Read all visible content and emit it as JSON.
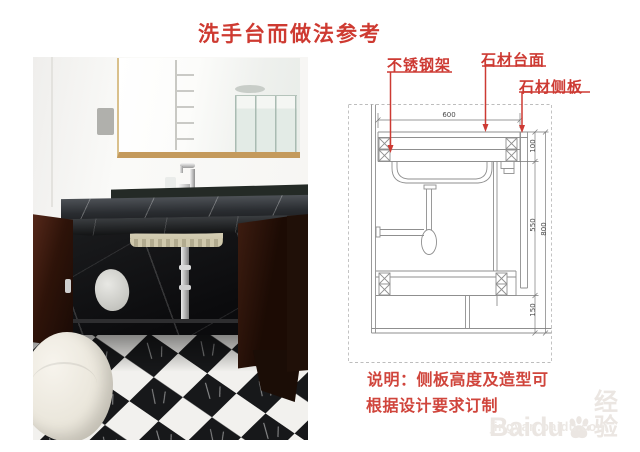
{
  "title": "洗手台而做法参考",
  "colors": {
    "accent_red": "#ce3a31",
    "drawing_line": "#909090",
    "watermark": "#ebe6e2"
  },
  "photo": {
    "items": [
      "mirror",
      "towel-rack-reflection",
      "shower-reflection",
      "light-switch",
      "faucet",
      "black-marble-countertop",
      "washbasin-underside",
      "p-trap-pipe",
      "open-cabinet-doors",
      "teapot",
      "checkered-marble-floor",
      "toilet"
    ]
  },
  "diagram": {
    "labels": {
      "steel_frame": "不锈钢架",
      "stone_top": "石材台面",
      "stone_side": "石材侧板"
    },
    "dims": {
      "width": "600",
      "top": "100",
      "side": "550",
      "overall": "800",
      "base": "150"
    },
    "note1": "说明：侧板高度及造型可",
    "note2": "根据设计要求订制"
  },
  "watermark": {
    "brand": "Baidu",
    "suffix": "经验",
    "url": "jingyan.baidu.com"
  }
}
